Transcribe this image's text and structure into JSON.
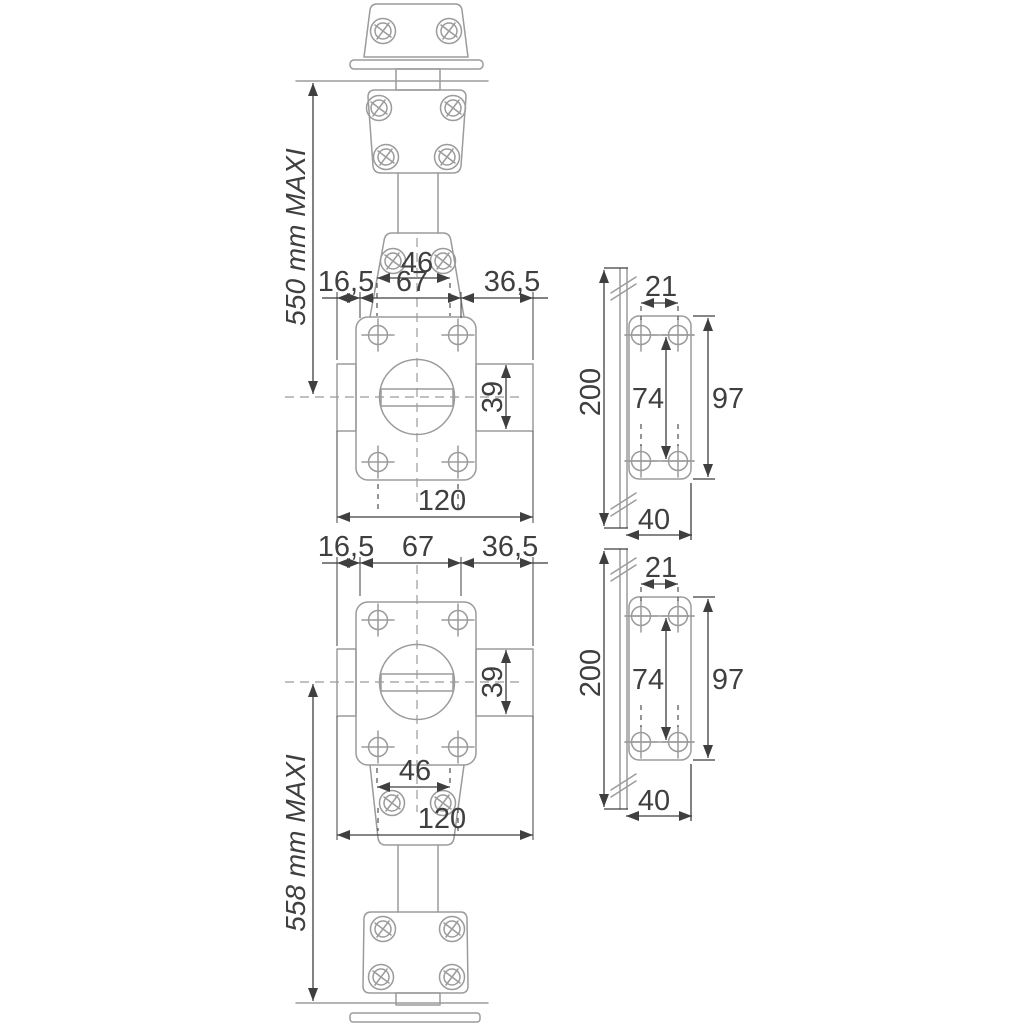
{
  "colors": {
    "background": "#ffffff",
    "outline": "#9b9b9b",
    "dimension": "#3f3f3f"
  },
  "top_assembly": {
    "max_height_label": "550 mm MAXI",
    "bracket_width": "46",
    "offset_left": "16,5",
    "body_width": "67",
    "offset_right": "36,5",
    "knob_height": "39",
    "total_width": "120"
  },
  "bottom_assembly": {
    "max_height_label": "558 mm MAXI",
    "bracket_width": "46",
    "offset_left": "16,5",
    "body_width": "67",
    "offset_right": "36,5",
    "knob_height": "39",
    "total_width": "120"
  },
  "strike_plate": {
    "total_height": "200",
    "hole_spacing_h": "21",
    "hole_spacing_v": "74",
    "plate_height": "97",
    "plate_width": "40"
  }
}
